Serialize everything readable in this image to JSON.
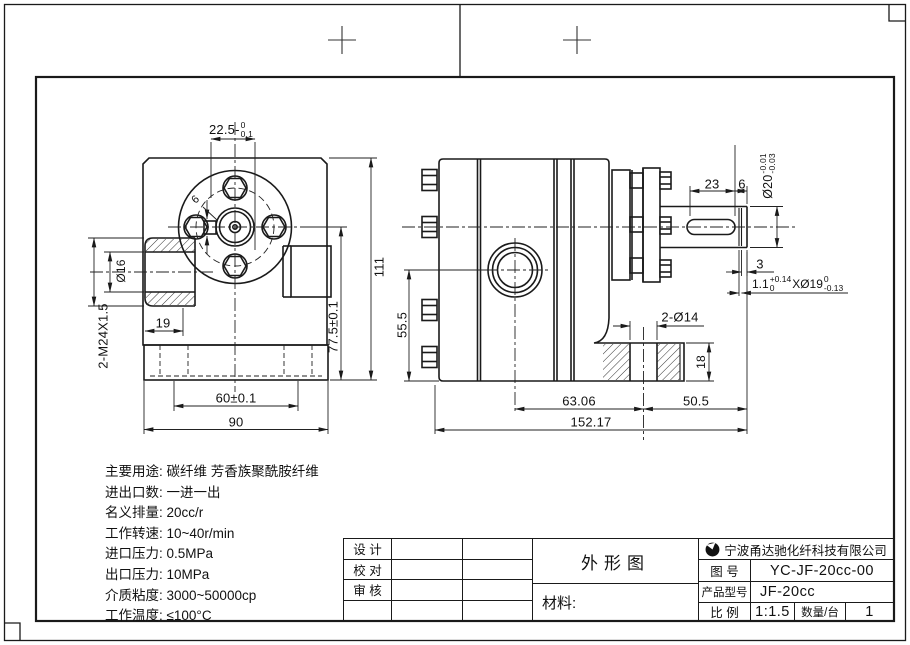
{
  "drawing": {
    "type": "engineering-drawing",
    "sheet_bg": "#ffffff",
    "line_color": "#1a1a1a"
  },
  "dims": {
    "front_width_main": "22.5-",
    "front_width_tol_up": "0",
    "front_width_tol_dn": "0.1",
    "front_key_width": "6",
    "front_bore": "Ø16",
    "front_thread": "2-M24X1.5",
    "front_port_depth": "19",
    "front_hole_spacing": "60±0.1",
    "front_base_width": "90",
    "front_port_height": "77.5±0.1",
    "front_total_height": "111",
    "side_port_height": "55.5",
    "side_key_length": "23",
    "side_shaft_tip": "6",
    "side_shaft_dia_main": "Ø20",
    "side_shaft_dia_tol_up": "-0.01",
    "side_shaft_dia_tol_dn": "-0.03",
    "side_end_step": "3",
    "side_groove_w": "1.1",
    "side_groove_w_tol_up": "+0.14",
    "side_groove_w_tol_dn": "0",
    "side_groove_d": "XØ19",
    "side_groove_d_tol_up": "0",
    "side_groove_d_tol_dn": "-0.13",
    "side_foot_holes": "2-Ø14",
    "side_foot_height": "18",
    "side_len_port_hole": "63.06",
    "side_len_hole_shaft": "50.5",
    "side_len_total": "152.17"
  },
  "specs": {
    "lines": [
      "主要用途: 碳纤维 芳香族聚酰胺纤维",
      "进出口数: 一进一出",
      "名义排量: 20cc/r",
      "工作转速: 10~40r/min",
      "进口压力: 0.5MPa",
      "出口压力: 10MPa",
      "介质粘度: 3000~50000cp",
      "工作温度: ≤100°C"
    ]
  },
  "title_block": {
    "design_label": "设  计",
    "check_label": "校  对",
    "audit_label": "审  核",
    "drawing_title": "外形图",
    "material_label": "材料:",
    "company": "宁波甬达驰化纤科技有限公司",
    "drawing_no_label": "图  号",
    "drawing_no": "YC-JF-20cc-00",
    "model_label": "产品型号",
    "model": "JF-20cc",
    "scale_label": "比  例",
    "scale": "1:1.5",
    "qty_label": "数量/台",
    "qty": "1"
  }
}
